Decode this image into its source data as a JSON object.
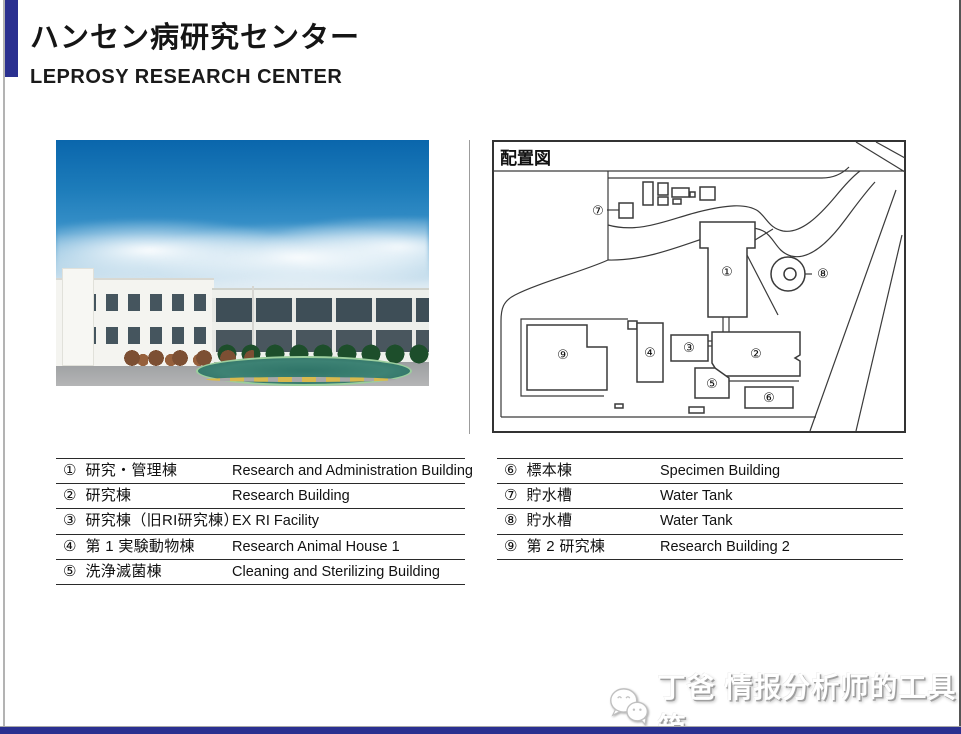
{
  "header": {
    "title_ja": "ハンセン病研究センター",
    "title_en": "LEPROSY RESEARCH CENTER"
  },
  "map": {
    "title": "配置図",
    "marks": [
      {
        "glyph": "①"
      },
      {
        "glyph": "②"
      },
      {
        "glyph": "③"
      },
      {
        "glyph": "④"
      },
      {
        "glyph": "⑤"
      },
      {
        "glyph": "⑥"
      },
      {
        "glyph": "⑦"
      },
      {
        "glyph": "⑧"
      },
      {
        "glyph": "⑨"
      }
    ]
  },
  "legend_left": {
    "rows": [
      {
        "num": "①",
        "ja": "研究・管理棟",
        "en": "Research and Administration Building"
      },
      {
        "num": "②",
        "ja": "研究棟",
        "en": "Research Building"
      },
      {
        "num": "③",
        "ja": "研究棟（旧RI研究棟）",
        "en": "EX RI Facility"
      },
      {
        "num": "④",
        "ja": "第 1 実験動物棟",
        "en": "Research Animal House 1"
      },
      {
        "num": "⑤",
        "ja": "洗浄滅菌棟",
        "en": "Cleaning and Sterilizing Building"
      }
    ]
  },
  "legend_right": {
    "rows": [
      {
        "num": "⑥",
        "ja": "標本棟",
        "en": "Specimen Building"
      },
      {
        "num": "⑦",
        "ja": "貯水槽",
        "en": "Water Tank"
      },
      {
        "num": "⑧",
        "ja": "貯水槽",
        "en": "Water Tank"
      },
      {
        "num": "⑨",
        "ja": "第 2 研究棟",
        "en": "Research Building 2"
      }
    ]
  },
  "watermark": {
    "text": "丁爸 情报分析师的工具箱"
  },
  "colors": {
    "accent_blue": "#2a3090"
  }
}
